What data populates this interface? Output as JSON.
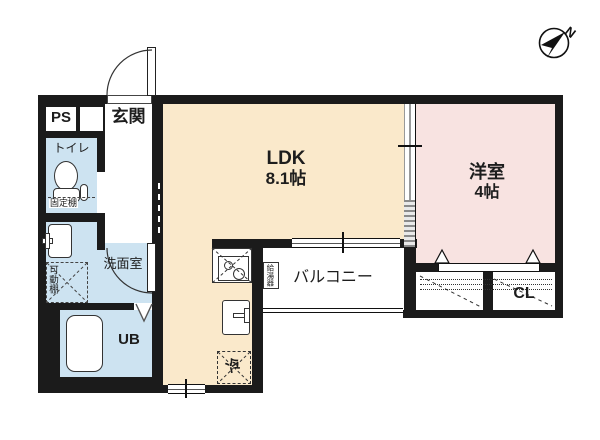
{
  "compass": {
    "north_label": "N"
  },
  "rooms": {
    "ps": {
      "label": "PS"
    },
    "entrance": {
      "label": "玄関"
    },
    "toilet": {
      "label": "トイレ",
      "shelf_label": "固定棚"
    },
    "washroom": {
      "label": "洗面室",
      "shelf_label": "可動棚"
    },
    "bathroom": {
      "label": "UB"
    },
    "ldk": {
      "label": "LDK",
      "size": "8.1帖"
    },
    "western_room": {
      "label": "洋室",
      "size": "4帖"
    },
    "balcony": {
      "label": "バルコニー",
      "water_heater_label": "給湯器"
    },
    "closet": {
      "label": "CL"
    },
    "kitchen": {
      "refrigerator_label": "冷"
    }
  },
  "colors": {
    "wall": "#1b1b1b",
    "ldk_fill": "#fae9cb",
    "western_room_fill": "#f8e3e1",
    "wet_area_fill": "#cde3f1",
    "background": "#ffffff"
  }
}
